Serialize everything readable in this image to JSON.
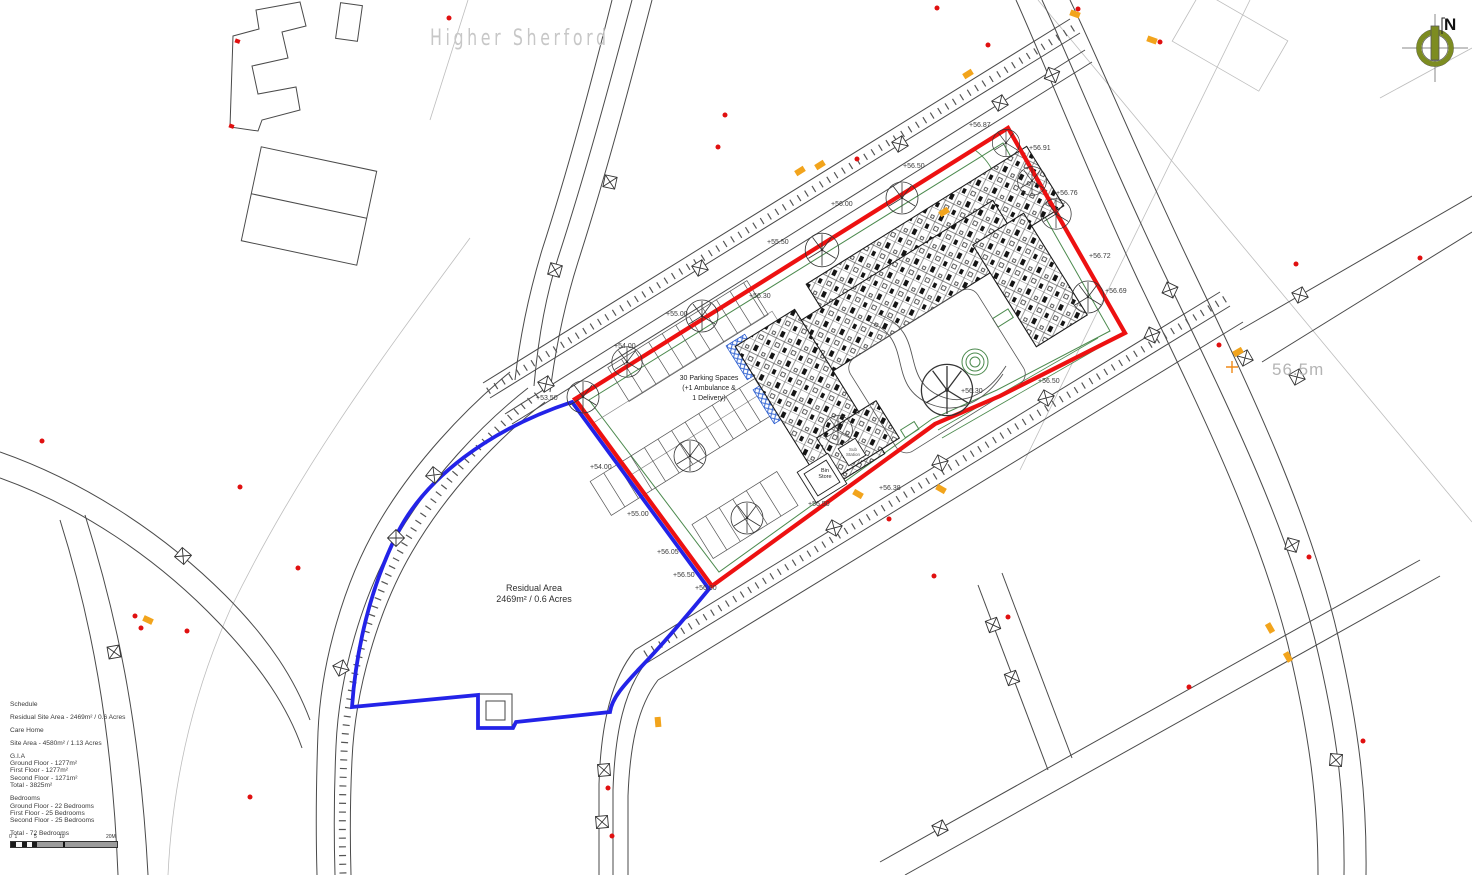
{
  "area_label": "Higher Sherford",
  "north_label": "N",
  "road_level_label": "56.5m",
  "residual_area": {
    "line1": "Residual Area",
    "line2": "2469m² / 0.6 Acres"
  },
  "parking_note": {
    "line1": "30 Parking Spaces",
    "line2": "(+1 Ambulance &",
    "line3": "1 Delivery)"
  },
  "bin_store": {
    "line1": "Bin",
    "line2": "Store"
  },
  "sub_station": {
    "line1": "Sub",
    "line2": "Station"
  },
  "spot_levels": [
    {
      "label": "+56.87",
      "x": 969,
      "y": 122
    },
    {
      "label": "+56.91",
      "x": 1029,
      "y": 145
    },
    {
      "label": "+56.76",
      "x": 1056,
      "y": 190
    },
    {
      "label": "+56.72",
      "x": 1089,
      "y": 253
    },
    {
      "label": "+56.69",
      "x": 1105,
      "y": 288
    },
    {
      "label": "+56.50",
      "x": 903,
      "y": 163
    },
    {
      "label": "+56.00",
      "x": 831,
      "y": 201
    },
    {
      "label": "+55.50",
      "x": 767,
      "y": 239
    },
    {
      "label": "+55.00",
      "x": 666,
      "y": 311
    },
    {
      "label": "+56.30",
      "x": 749,
      "y": 293
    },
    {
      "label": "+54.00",
      "x": 614,
      "y": 343
    },
    {
      "label": "+53.50",
      "x": 536,
      "y": 395
    },
    {
      "label": "+54.00",
      "x": 590,
      "y": 464
    },
    {
      "label": "+55.00",
      "x": 627,
      "y": 511
    },
    {
      "label": "+56.05",
      "x": 657,
      "y": 549
    },
    {
      "label": "+56.50",
      "x": 673,
      "y": 572
    },
    {
      "label": "+56.80",
      "x": 695,
      "y": 585
    },
    {
      "label": "+56.30",
      "x": 961,
      "y": 388
    },
    {
      "label": "+56.50",
      "x": 1038,
      "y": 378
    },
    {
      "label": "+56.38",
      "x": 879,
      "y": 485
    },
    {
      "label": "+56.50",
      "x": 808,
      "y": 501
    }
  ],
  "schedule": {
    "lines": [
      "Schedule",
      "",
      "Residual Site Area - 2469m² / 0.6 Acres",
      "",
      "Care Home",
      "",
      "Site Area - 4580m² / 1.13 Acres",
      "",
      "G.I.A",
      "Ground Floor - 1277m²",
      "First Floor - 1277m²",
      "Second Floor - 1271m²",
      "Total - 3825m²",
      "",
      "Bedrooms",
      "Ground Floor - 22 Bedrooms",
      "First Floor - 25 Bedrooms",
      "Second Floor - 25 Bedrooms",
      "",
      "Total - 72 Bedrooms"
    ]
  },
  "scale_bar": {
    "labels": [
      {
        "text": "0",
        "x": -1
      },
      {
        "text": "1",
        "x": 4.5
      },
      {
        "text": "5",
        "x": 24
      },
      {
        "text": "10",
        "x": 49
      },
      {
        "text": "20M",
        "x": 96
      }
    ]
  },
  "colors": {
    "boundary-red": "#ed1111",
    "boundary-blue": "#2323e8",
    "landscape-green": "#4c8a4e",
    "north-olive": "#7d8c21",
    "marker-orange": "#f2a41c",
    "survey-red": "#e01010"
  }
}
